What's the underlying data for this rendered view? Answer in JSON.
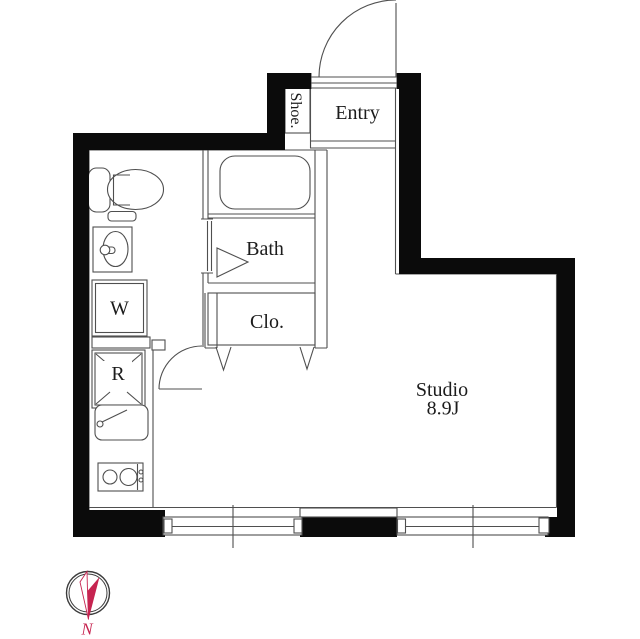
{
  "floor_plan": {
    "labels": {
      "shoe": "Shoe.",
      "entry": "Entry",
      "bath": "Bath",
      "closet": "Clo.",
      "washer": "W",
      "refrigerator": "R",
      "studio": "Studio",
      "studio_area": "8.9J"
    },
    "compass": {
      "north": "N"
    },
    "colors": {
      "wall": "#0b0b0b",
      "partition_line": "#4f4f4f",
      "label_text": "#1c1c1c",
      "compass_accent": "#c62450",
      "background": "#ffffff"
    }
  }
}
